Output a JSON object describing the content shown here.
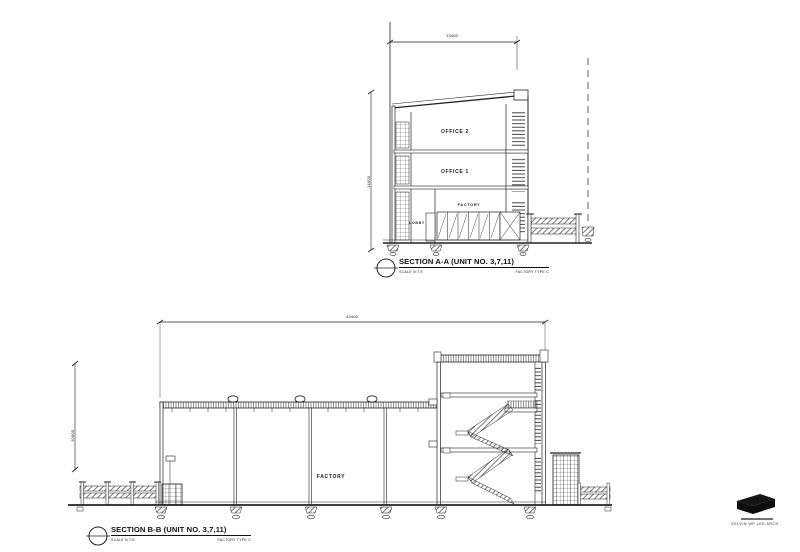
{
  "sheet": {
    "background": "#ffffff",
    "ink": "#1f1f1f"
  },
  "section_a": {
    "title": "SECTION A-A (UNIT NO. 3,7,11)",
    "scale_note": "SCALE  N.T.S",
    "type_note": "FACTORY   TYPE C",
    "rooms": {
      "office2": "OFFICE 2",
      "office1": "OFFICE 1",
      "factory": "FACTORY",
      "lobby": "LOBBY"
    },
    "dims": {
      "width": "13400",
      "height": "14600"
    }
  },
  "section_b": {
    "title": "SECTION B-B (UNIT NO. 3,7,11)",
    "scale_note": "SCALE  N.T.S",
    "type_note": "FACTORY   TYPE C",
    "rooms": {
      "factory": "FACTORY"
    },
    "dims": {
      "length": "42400",
      "height": "10000"
    }
  },
  "title_block": {
    "firm": "KELVIN WP LEE ARCH"
  }
}
